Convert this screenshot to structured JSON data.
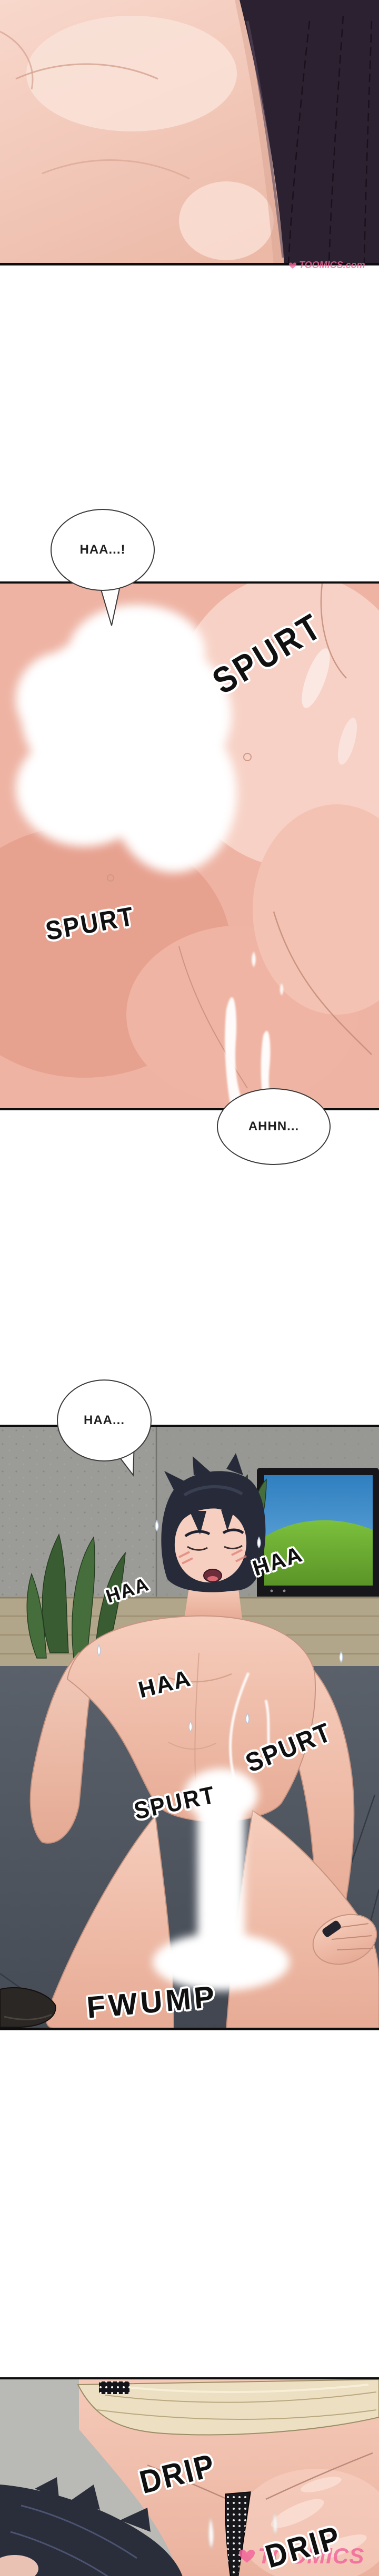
{
  "comic": {
    "bubbles": [
      {
        "name": "bubble-haa-1",
        "text": "HAA...!"
      },
      {
        "name": "bubble-ahhn",
        "text": "AHHN..."
      },
      {
        "name": "bubble-haa-2",
        "text": "HAA..."
      }
    ],
    "sfx": [
      {
        "name": "sfx-spurt-top",
        "text": "SPURT"
      },
      {
        "name": "sfx-spurt-left",
        "text": "SPURT"
      },
      {
        "name": "sfx-haa-shoulder",
        "text": "HAA"
      },
      {
        "name": "sfx-haa-face",
        "text": "HAA"
      },
      {
        "name": "sfx-haa-chest",
        "text": "HAA"
      },
      {
        "name": "sfx-spurt-torso",
        "text": "SPURT"
      },
      {
        "name": "sfx-spurt-crotch",
        "text": "SPURT"
      },
      {
        "name": "sfx-fwump",
        "text": "FWUMP"
      },
      {
        "name": "sfx-drip-1",
        "text": "DRIP"
      },
      {
        "name": "sfx-drip-2",
        "text": "DRIP"
      }
    ],
    "watermarks": {
      "top": "TOOMICS.com",
      "bottom": "TOOMICS"
    },
    "colors": {
      "page_background": "#ffffff",
      "panel_border": "#0d0d0d",
      "sfx_ink": "#101010",
      "sfx_outline": "#ffffff",
      "watermark_pink": "#f2679c",
      "tv_sky": "#4a90cc",
      "tv_hill": "#6fae34",
      "wall_gray": "#9b9b97",
      "floor_gray": "#545b65",
      "cabinet_tan": "#b2a68a"
    }
  }
}
